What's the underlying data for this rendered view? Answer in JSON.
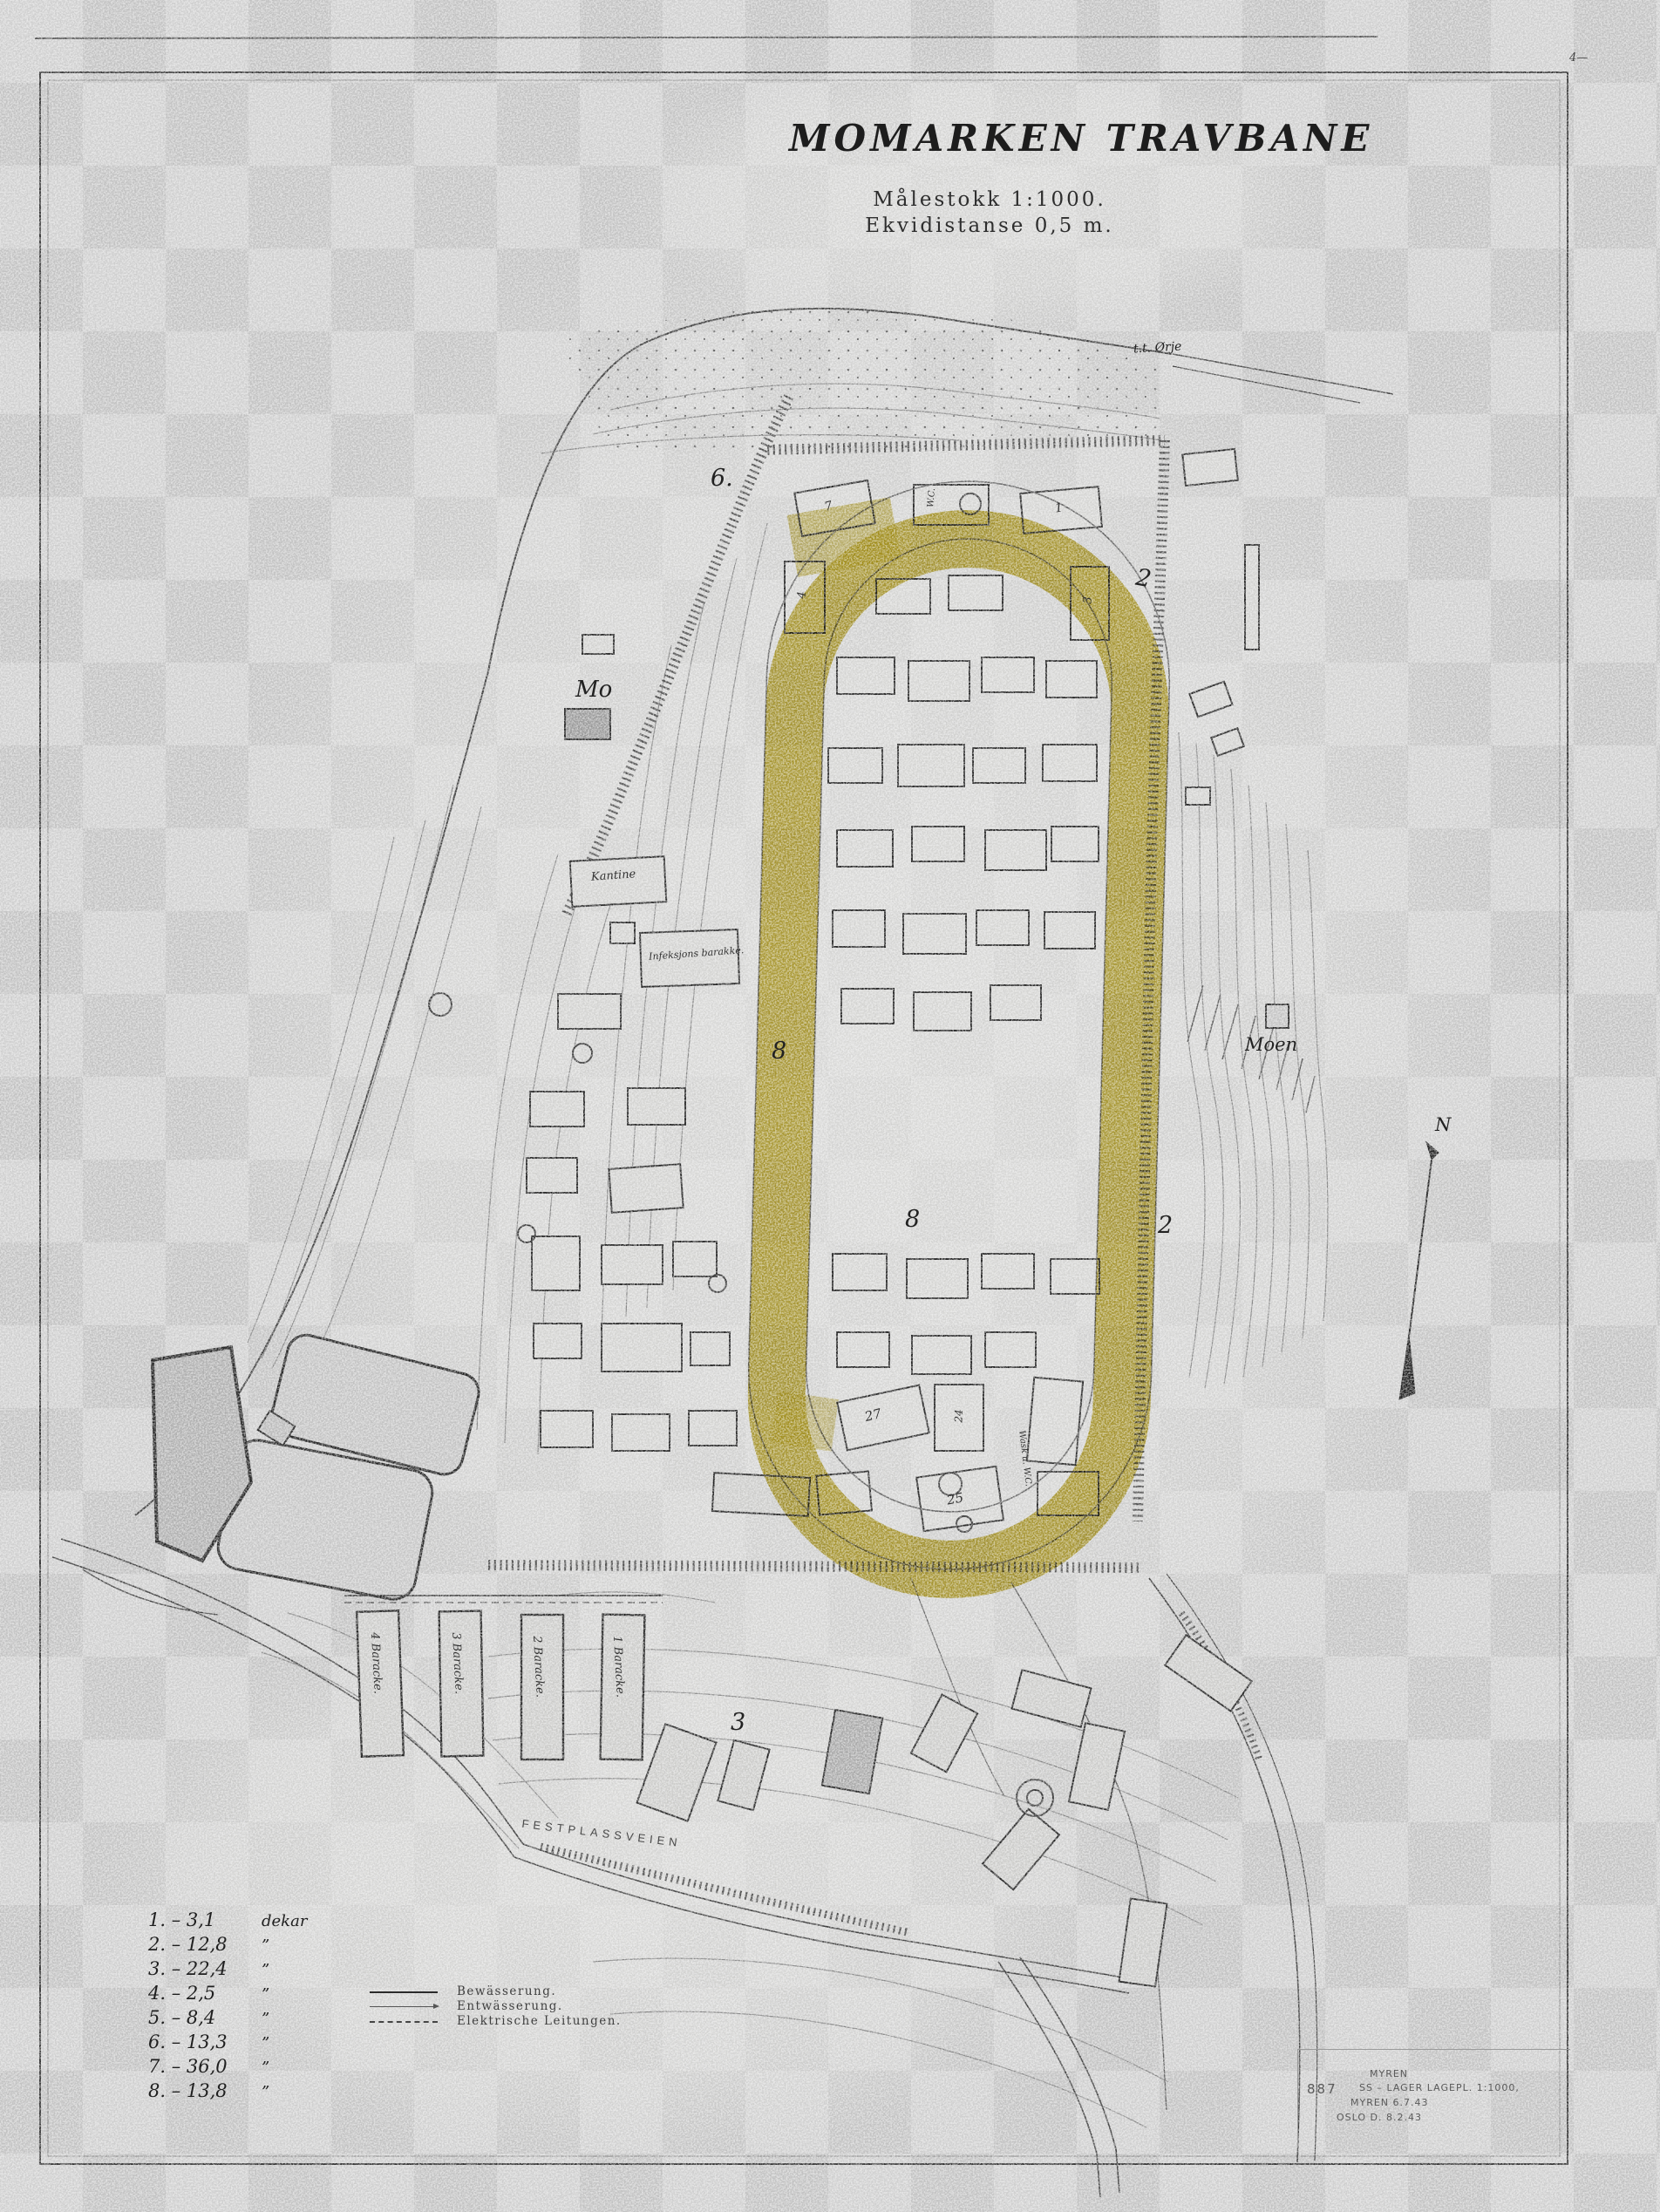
{
  "document": {
    "title": "MOMARKEN TRAVBANE",
    "scale_line1": "Målestokk 1:1000.",
    "scale_line2": "Ekvidistanse 0,5 m.",
    "corner_mark_top_right": "4—",
    "north_letter": "N"
  },
  "area_legend": {
    "rows": [
      {
        "label": "1. –  3,1",
        "unit": "dekar"
      },
      {
        "label": "2. – 12,8",
        "unit": "”"
      },
      {
        "label": "3. – 22,4",
        "unit": "”"
      },
      {
        "label": "4. –  2,5",
        "unit": "”"
      },
      {
        "label": "5. –  8,4",
        "unit": "”"
      },
      {
        "label": "6. – 13,3",
        "unit": "”"
      },
      {
        "label": "7. – 36,0",
        "unit": "”"
      },
      {
        "label": "8. – 13,8",
        "unit": "”"
      }
    ]
  },
  "line_legend": {
    "items": [
      {
        "label": "Bewässerung."
      },
      {
        "label": "Entwässerung."
      },
      {
        "label": "Elektrische Leitungen."
      }
    ]
  },
  "map_labels": {
    "mo": "Mo",
    "moen": "Moen",
    "road_top": "t.t. Ørje",
    "road_bottom": "FESTPLASSVEIEN",
    "area6": "6.",
    "area2_top": "2",
    "area8_left": "8",
    "area8_mid": "8",
    "area2_right": "2",
    "area3": "3"
  },
  "building_labels": {
    "wc": "W.C.",
    "b7": "7",
    "b1": "1",
    "b4": "4",
    "b3": "3",
    "b27": "27",
    "b24": "24",
    "b25": "25",
    "wask": "Wask u. W.C.",
    "kantine": "Kantine",
    "infeksjon": "Infeksjons barakke."
  },
  "barracks": [
    {
      "label": "4 Baracke."
    },
    {
      "label": "3 Baracke."
    },
    {
      "label": "2 Baracke."
    },
    {
      "label": "1 Baracke."
    }
  ],
  "annotation_block": {
    "number": "887",
    "line1": "MYREN",
    "line2": "SS – LAGER  LAGEPL. 1:1000,",
    "line3": "MYREN 6.7.43",
    "line4": "OSLO D. 8.2.43"
  },
  "colors": {
    "track_highlight": "#b89e06",
    "ink": "#2b2b2b",
    "checker_dark": "#c5c5c5",
    "checker_light": "#d2d2d2"
  }
}
